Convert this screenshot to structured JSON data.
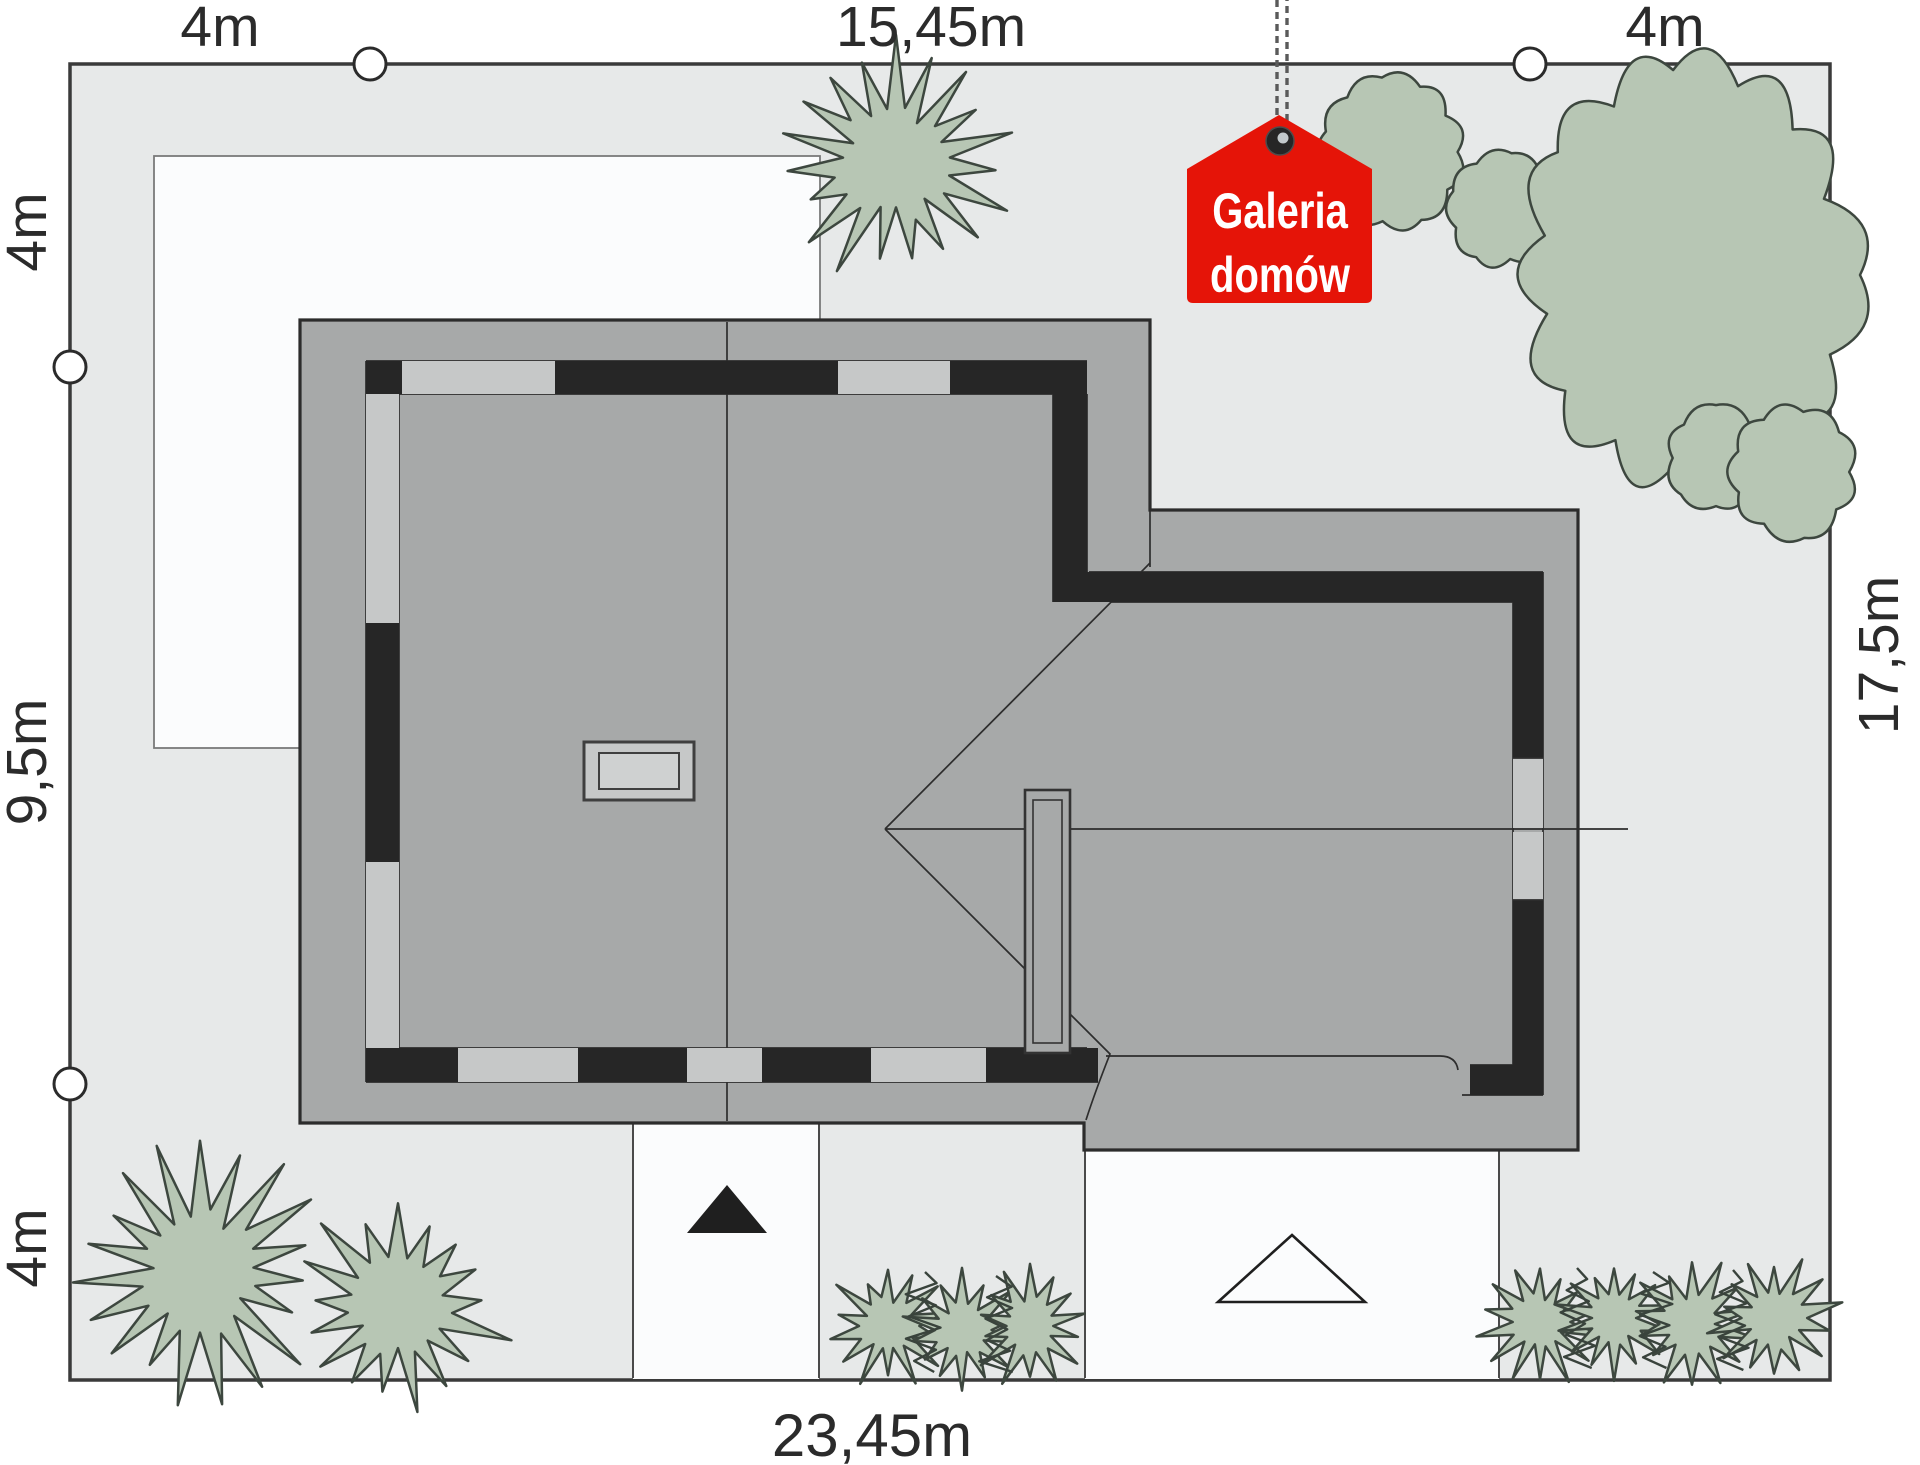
{
  "dimensions": {
    "top_left": "4m",
    "top_center": "15,45m",
    "top_right": "4m",
    "left_top": "4m",
    "left_middle": "9,5m",
    "left_bottom": "4m",
    "right_side": "17,5m",
    "bottom": "23,45m"
  },
  "logo": {
    "line1": "Galeria",
    "line2": "domów"
  },
  "colors": {
    "plot_fill": "#e7e9e9",
    "paved_fill": "#fbfcfd",
    "roof_fill": "#a7a9a9",
    "roof_band_black": "#262626",
    "roof_band_light": "#c6c8c8",
    "outline": "#2d2d2d",
    "vegetation_fill": "#b7c6b4",
    "vegetation_outline": "#3d473f",
    "logo_red": "#e51408",
    "logo_text": "#ffffff",
    "dimension_text": "#2b2b2b"
  },
  "icons": {
    "entrance_arrow": "filled-up-triangle",
    "garage_arrow": "outlined-up-triangle",
    "boundary_marker": "circle",
    "logo_tag": "house-shaped-tag",
    "logo_chain": "hanging-chain"
  }
}
